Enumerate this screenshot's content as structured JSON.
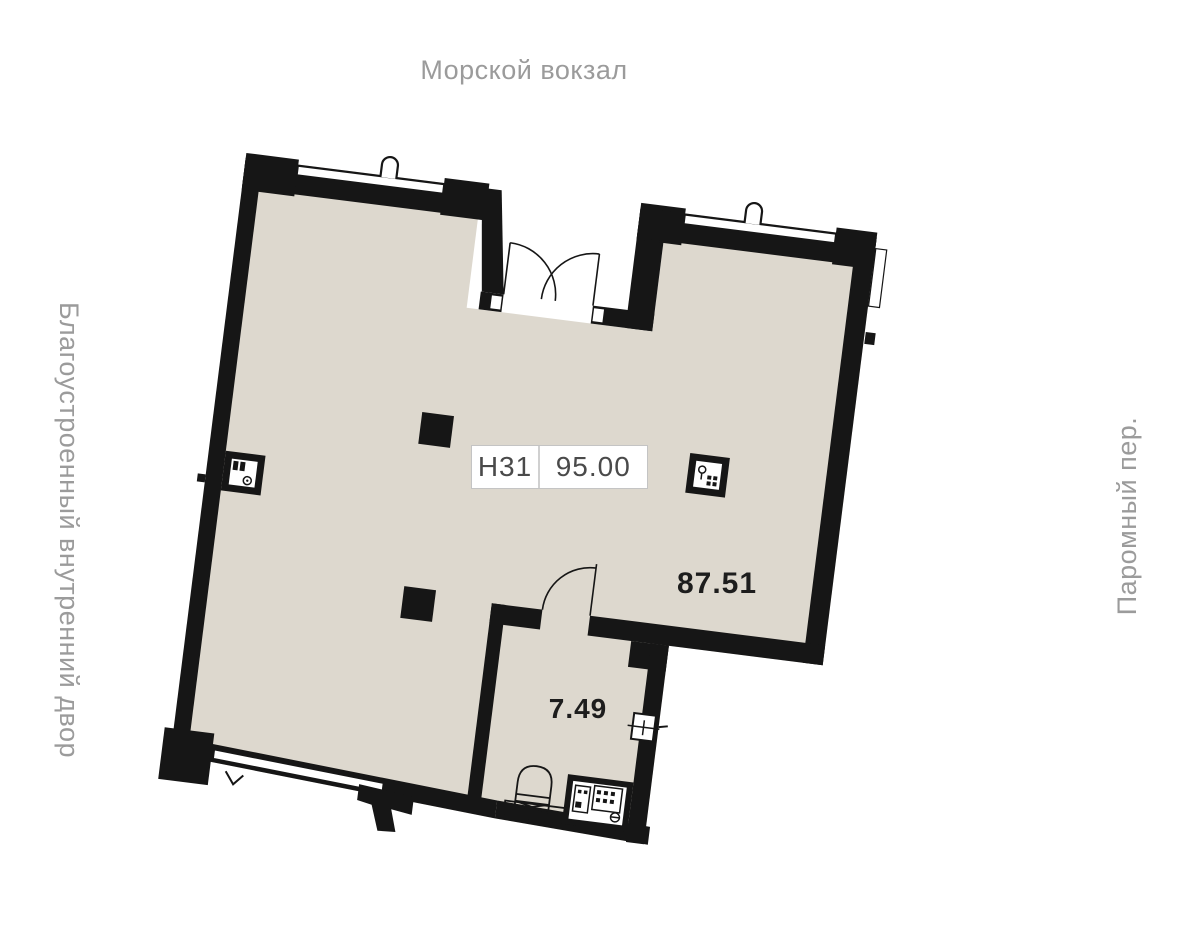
{
  "plan": {
    "surroundings": {
      "top": "Морской вокзал",
      "left": "Благоустроенный внутренний двор",
      "right": "Паромный пер."
    },
    "unit": {
      "number": "Н31",
      "total_area": "95.00",
      "areas": {
        "main": "87.51",
        "secondary": "7.49"
      }
    }
  },
  "colors": {
    "background": "#FFFFFF",
    "floor": "#DDD8CE",
    "walls": "#161616",
    "street_labels": "#9B9B9B",
    "area_labels": "#1D1D1D",
    "badge_border": "#C4C4C4",
    "badge_text": "#4A4A4A"
  },
  "icons": {
    "entrance": "double-door-icon",
    "interior": "door-swing-icon",
    "structure": "column-icon",
    "sanitary": "toilet-icon",
    "risers": [
      "plumbing-shaft-icon",
      "electrical-shaft-icon",
      "ventilation-shaft-icon"
    ],
    "wall_marks": [
      "window-icon",
      "vent-icon",
      "socket-icon",
      "ramp-icon"
    ]
  }
}
